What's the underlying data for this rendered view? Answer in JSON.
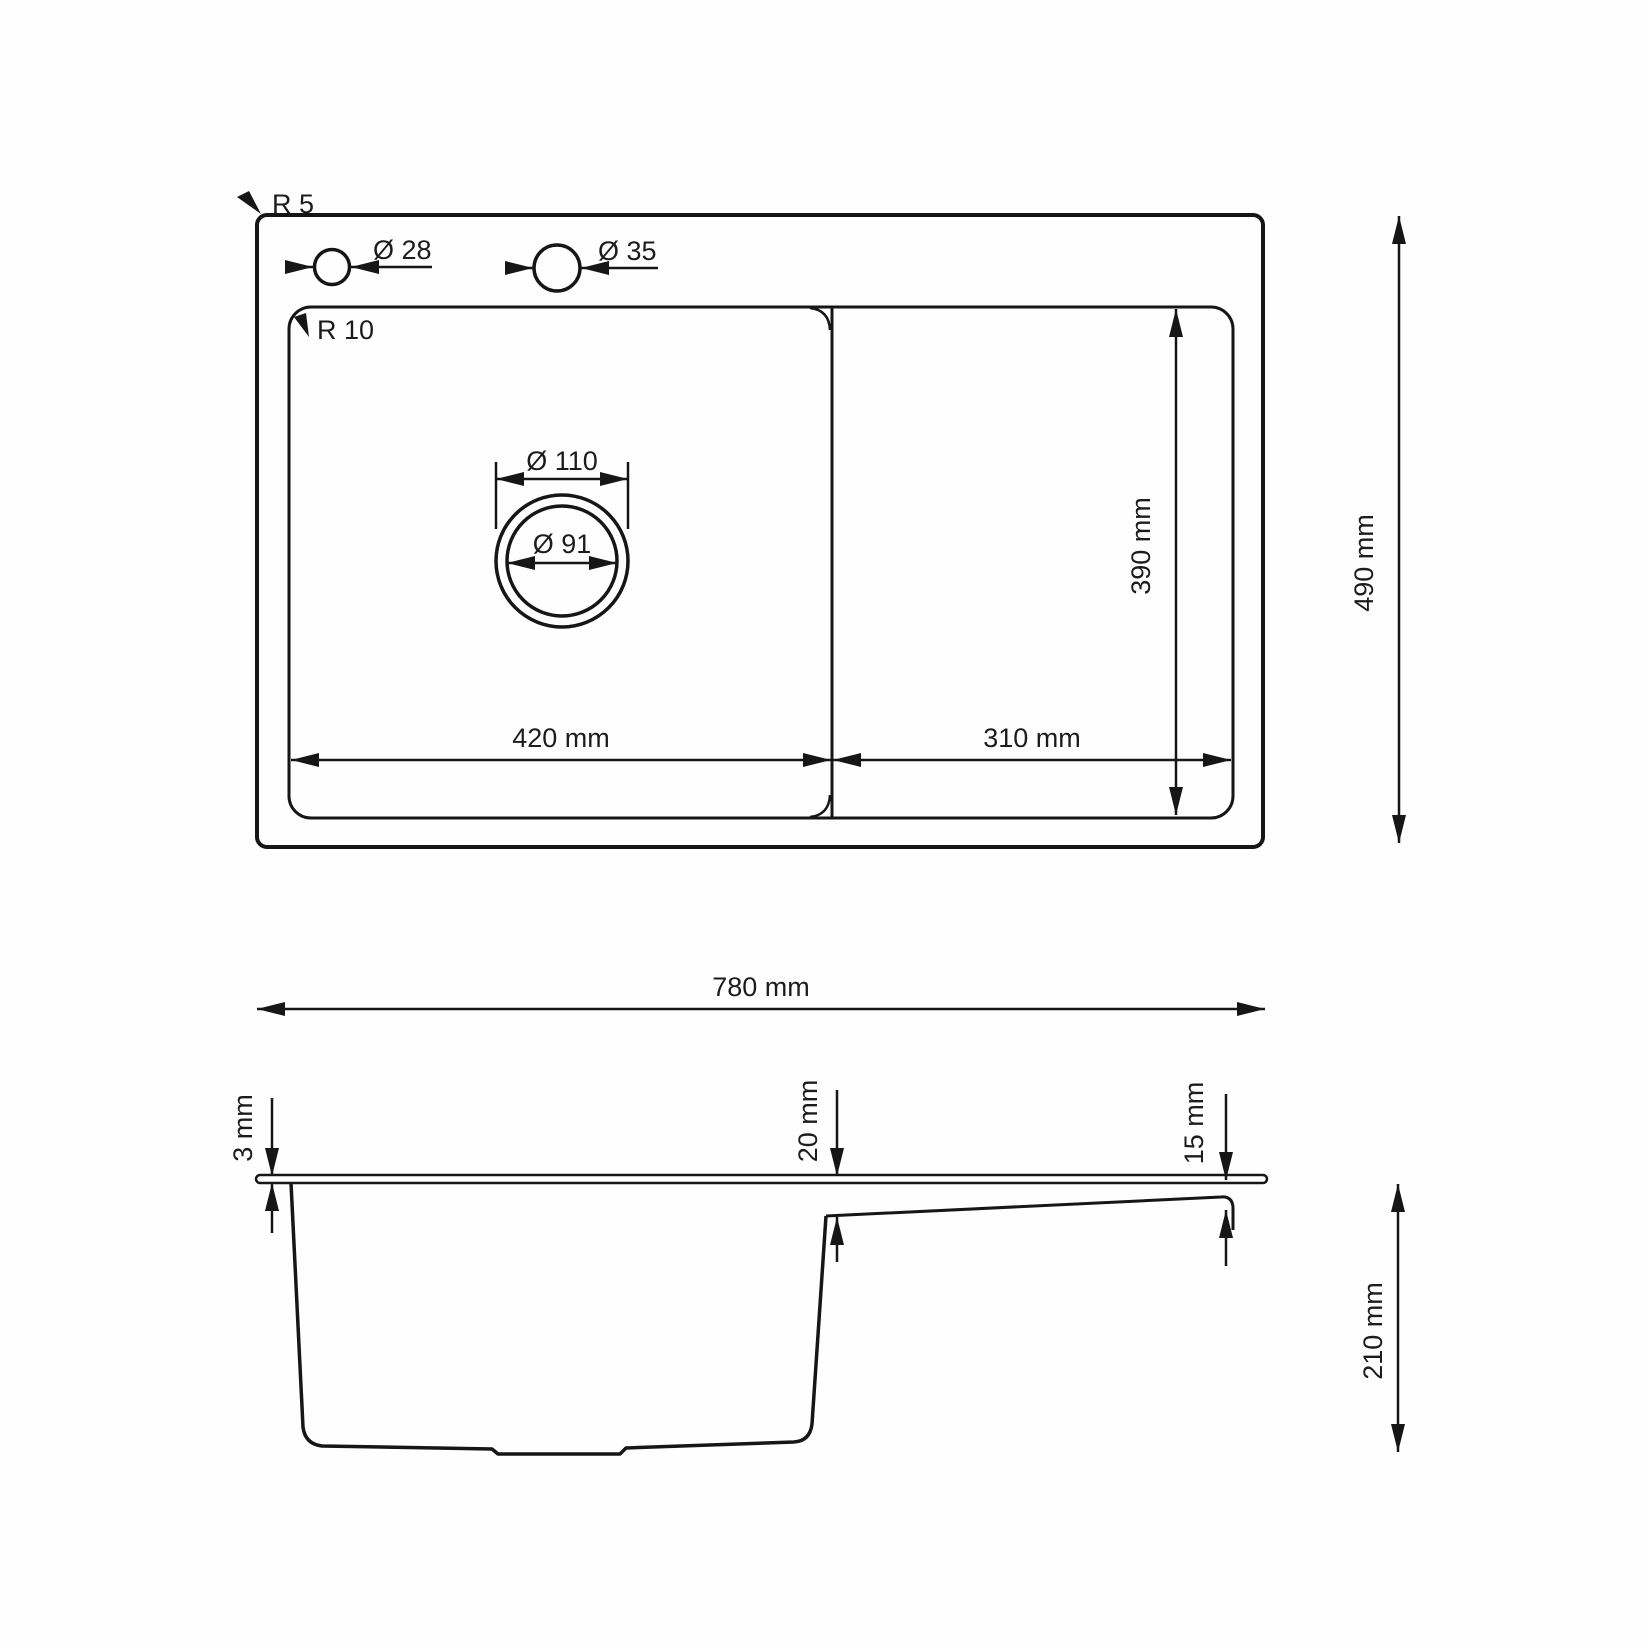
{
  "page": {
    "background": "#fefefe",
    "line_color": "#161616"
  },
  "top_view": {
    "radius_outer_label": "R 5",
    "radius_inner_label": "R 10",
    "faucet_hole_small_label": "Ø 28",
    "faucet_hole_large_label": "Ø 35",
    "drain_outer_label": "Ø 110",
    "drain_inner_label": "Ø 91",
    "bowl_width_label": "420 mm",
    "drainboard_width_label": "310 mm",
    "bowl_depth_label": "390 mm",
    "overall_depth_label": "490 mm"
  },
  "front_view": {
    "overall_width_label": "780 mm",
    "rim_thickness_label": "3 mm",
    "bowl_edge_drop_label": "20 mm",
    "drainboard_edge_drop_label": "15 mm",
    "bowl_height_label": "210 mm"
  }
}
